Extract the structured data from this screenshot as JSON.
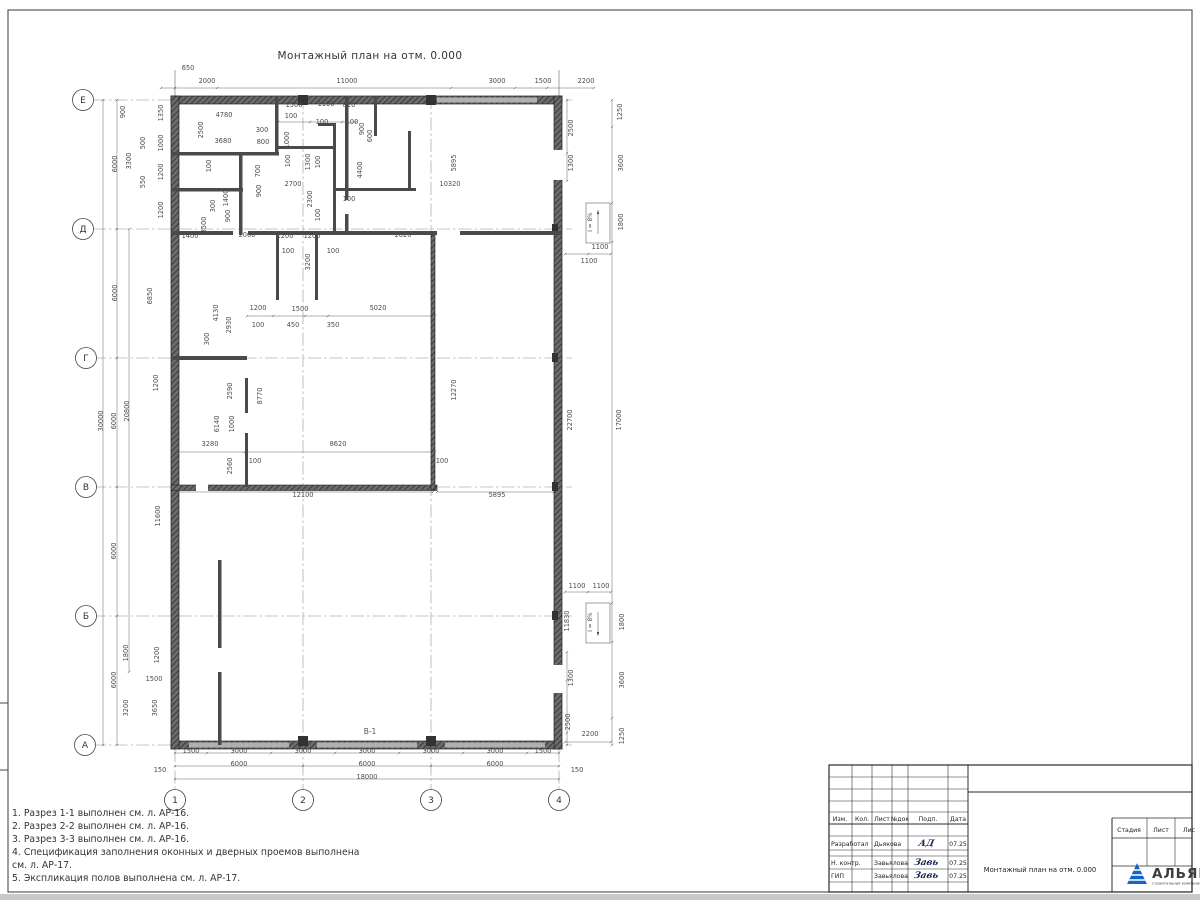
{
  "sheet": {
    "drawing_title": "Монтажный план на отм. 0.000",
    "window_mark": "В-1",
    "ramp_label": "i = 8%"
  },
  "axes": {
    "rows": [
      {
        "label": "Е",
        "x": 83,
        "y": 100
      },
      {
        "label": "Д",
        "x": 83,
        "y": 229
      },
      {
        "label": "Г",
        "x": 86,
        "y": 358
      },
      {
        "label": "В",
        "x": 86,
        "y": 487
      },
      {
        "label": "Б",
        "x": 86,
        "y": 616
      },
      {
        "label": "А",
        "x": 85,
        "y": 745
      }
    ],
    "cols": [
      {
        "label": "1",
        "x": 175,
        "y": 800
      },
      {
        "label": "2",
        "x": 303,
        "y": 800
      },
      {
        "label": "3",
        "x": 431,
        "y": 800
      },
      {
        "label": "4",
        "x": 559,
        "y": 800
      }
    ]
  },
  "dimensions": [
    {
      "x": 188,
      "y": 70,
      "t": "650"
    },
    {
      "x": 207,
      "y": 83,
      "t": "2000"
    },
    {
      "x": 347,
      "y": 83,
      "t": "11000"
    },
    {
      "x": 497,
      "y": 83,
      "t": "3000"
    },
    {
      "x": 543,
      "y": 83,
      "t": "1500"
    },
    {
      "x": 586,
      "y": 83,
      "t": "2200"
    },
    {
      "x": 294,
      "y": 107,
      "t": "1500"
    },
    {
      "x": 326,
      "y": 106,
      "t": "1100"
    },
    {
      "x": 349,
      "y": 107,
      "t": "820"
    },
    {
      "x": 291,
      "y": 118,
      "t": "100"
    },
    {
      "x": 322,
      "y": 124,
      "t": "100"
    },
    {
      "x": 352,
      "y": 124,
      "t": "100"
    },
    {
      "x": 364,
      "y": 129,
      "t": "900",
      "r": 1
    },
    {
      "x": 372,
      "y": 136,
      "t": "600",
      "r": 1
    },
    {
      "x": 117,
      "y": 164,
      "t": "6000",
      "r": 1
    },
    {
      "x": 117,
      "y": 293,
      "t": "6000",
      "r": 1
    },
    {
      "x": 116,
      "y": 421,
      "t": "6000",
      "r": 1
    },
    {
      "x": 116,
      "y": 551,
      "t": "6000",
      "r": 1
    },
    {
      "x": 116,
      "y": 680,
      "t": "6000",
      "r": 1
    },
    {
      "x": 103,
      "y": 421,
      "t": "30000",
      "r": 1
    },
    {
      "x": 129,
      "y": 411,
      "t": "20800",
      "r": 1
    },
    {
      "x": 160,
      "y": 516,
      "t": "11600",
      "r": 1
    },
    {
      "x": 152,
      "y": 296,
      "t": "6850",
      "r": 1
    },
    {
      "x": 125,
      "y": 112,
      "t": "900",
      "r": 1
    },
    {
      "x": 131,
      "y": 161,
      "t": "3300",
      "r": 1
    },
    {
      "x": 145,
      "y": 143,
      "t": "500",
      "r": 1
    },
    {
      "x": 145,
      "y": 182,
      "t": "550",
      "r": 1
    },
    {
      "x": 163,
      "y": 113,
      "t": "1350",
      "r": 1
    },
    {
      "x": 163,
      "y": 143,
      "t": "1000",
      "r": 1
    },
    {
      "x": 163,
      "y": 172,
      "t": "1200",
      "r": 1
    },
    {
      "x": 163,
      "y": 210,
      "t": "1200",
      "r": 1
    },
    {
      "x": 158,
      "y": 383,
      "t": "1200",
      "r": 1
    },
    {
      "x": 128,
      "y": 653,
      "t": "1800",
      "r": 1
    },
    {
      "x": 159,
      "y": 655,
      "t": "1200",
      "r": 1
    },
    {
      "x": 128,
      "y": 708,
      "t": "3200",
      "r": 1
    },
    {
      "x": 157,
      "y": 708,
      "t": "3650",
      "r": 1
    },
    {
      "x": 154,
      "y": 681,
      "t": "1500"
    },
    {
      "x": 191,
      "y": 753,
      "t": "1500"
    },
    {
      "x": 239,
      "y": 753,
      "t": "3000"
    },
    {
      "x": 303,
      "y": 753,
      "t": "3000"
    },
    {
      "x": 367,
      "y": 753,
      "t": "3000"
    },
    {
      "x": 431,
      "y": 753,
      "t": "3000"
    },
    {
      "x": 495,
      "y": 753,
      "t": "3000"
    },
    {
      "x": 543,
      "y": 753,
      "t": "1500"
    },
    {
      "x": 239,
      "y": 766,
      "t": "6000"
    },
    {
      "x": 367,
      "y": 766,
      "t": "6000"
    },
    {
      "x": 495,
      "y": 766,
      "t": "6000"
    },
    {
      "x": 367,
      "y": 779,
      "t": "18000"
    },
    {
      "x": 160,
      "y": 772,
      "t": "150"
    },
    {
      "x": 577,
      "y": 772,
      "t": "150"
    },
    {
      "x": 573,
      "y": 128,
      "t": "2500",
      "r": 1
    },
    {
      "x": 573,
      "y": 163,
      "t": "1300",
      "r": 1
    },
    {
      "x": 622,
      "y": 112,
      "t": "1250",
      "r": 1
    },
    {
      "x": 623,
      "y": 163,
      "t": "3600",
      "r": 1
    },
    {
      "x": 623,
      "y": 222,
      "t": "1800",
      "r": 1
    },
    {
      "x": 600,
      "y": 249,
      "t": "1100"
    },
    {
      "x": 589,
      "y": 263,
      "t": "1100"
    },
    {
      "x": 577,
      "y": 588,
      "t": "1100"
    },
    {
      "x": 601,
      "y": 588,
      "t": "1100"
    },
    {
      "x": 624,
      "y": 622,
      "t": "1800",
      "r": 1
    },
    {
      "x": 624,
      "y": 680,
      "t": "3600",
      "r": 1
    },
    {
      "x": 624,
      "y": 736,
      "t": "1250",
      "r": 1
    },
    {
      "x": 590,
      "y": 736,
      "t": "2200"
    },
    {
      "x": 573,
      "y": 678,
      "t": "1300",
      "r": 1
    },
    {
      "x": 570,
      "y": 722,
      "t": "2500",
      "r": 1
    },
    {
      "x": 572,
      "y": 420,
      "t": "22700",
      "r": 1
    },
    {
      "x": 621,
      "y": 420,
      "t": "17000",
      "r": 1
    },
    {
      "x": 569,
      "y": 621,
      "t": "11830",
      "r": 1
    },
    {
      "x": 456,
      "y": 390,
      "t": "12270",
      "r": 1
    },
    {
      "x": 224,
      "y": 117,
      "t": "4780"
    },
    {
      "x": 203,
      "y": 130,
      "t": "2500",
      "r": 1
    },
    {
      "x": 223,
      "y": 143,
      "t": "3680"
    },
    {
      "x": 262,
      "y": 132,
      "t": "300"
    },
    {
      "x": 263,
      "y": 144,
      "t": "800"
    },
    {
      "x": 289,
      "y": 140,
      "t": "1000",
      "r": 1
    },
    {
      "x": 310,
      "y": 162,
      "t": "1300",
      "r": 1
    },
    {
      "x": 290,
      "y": 161,
      "t": "100",
      "r": 1
    },
    {
      "x": 320,
      "y": 162,
      "t": "100",
      "r": 1
    },
    {
      "x": 260,
      "y": 171,
      "t": "700",
      "r": 1
    },
    {
      "x": 261,
      "y": 191,
      "t": "900",
      "r": 1
    },
    {
      "x": 293,
      "y": 186,
      "t": "2700"
    },
    {
      "x": 312,
      "y": 199,
      "t": "2300",
      "r": 1
    },
    {
      "x": 349,
      "y": 201,
      "t": "100"
    },
    {
      "x": 320,
      "y": 215,
      "t": "100",
      "r": 1
    },
    {
      "x": 362,
      "y": 170,
      "t": "4400",
      "r": 1
    },
    {
      "x": 211,
      "y": 166,
      "t": "100",
      "r": 1
    },
    {
      "x": 228,
      "y": 198,
      "t": "1400",
      "r": 1
    },
    {
      "x": 215,
      "y": 206,
      "t": "300",
      "r": 1
    },
    {
      "x": 230,
      "y": 216,
      "t": "900",
      "r": 1
    },
    {
      "x": 206,
      "y": 225,
      "t": "3500",
      "r": 1
    },
    {
      "x": 190,
      "y": 238,
      "t": "1400"
    },
    {
      "x": 247,
      "y": 237,
      "t": "2000"
    },
    {
      "x": 285,
      "y": 238,
      "t": "1200"
    },
    {
      "x": 312,
      "y": 238,
      "t": "1200"
    },
    {
      "x": 403,
      "y": 237,
      "t": "2620"
    },
    {
      "x": 288,
      "y": 253,
      "t": "100"
    },
    {
      "x": 333,
      "y": 253,
      "t": "100"
    },
    {
      "x": 310,
      "y": 262,
      "t": "3200",
      "r": 1
    },
    {
      "x": 258,
      "y": 310,
      "t": "1200"
    },
    {
      "x": 300,
      "y": 311,
      "t": "1500"
    },
    {
      "x": 378,
      "y": 310,
      "t": "5020"
    },
    {
      "x": 293,
      "y": 327,
      "t": "450"
    },
    {
      "x": 333,
      "y": 327,
      "t": "350"
    },
    {
      "x": 258,
      "y": 327,
      "t": "100"
    },
    {
      "x": 218,
      "y": 313,
      "t": "4130",
      "r": 1
    },
    {
      "x": 231,
      "y": 325,
      "t": "2930",
      "r": 1
    },
    {
      "x": 209,
      "y": 339,
      "t": "300",
      "r": 1
    },
    {
      "x": 232,
      "y": 391,
      "t": "2590",
      "r": 1
    },
    {
      "x": 262,
      "y": 396,
      "t": "8770",
      "r": 1
    },
    {
      "x": 219,
      "y": 424,
      "t": "6140",
      "r": 1
    },
    {
      "x": 234,
      "y": 424,
      "t": "1000",
      "r": 1
    },
    {
      "x": 210,
      "y": 446,
      "t": "3280"
    },
    {
      "x": 338,
      "y": 446,
      "t": "8620"
    },
    {
      "x": 232,
      "y": 466,
      "t": "2560",
      "r": 1
    },
    {
      "x": 255,
      "y": 463,
      "t": "100"
    },
    {
      "x": 442,
      "y": 463,
      "t": "100"
    },
    {
      "x": 303,
      "y": 497,
      "t": "12100"
    },
    {
      "x": 497,
      "y": 497,
      "t": "5895"
    },
    {
      "x": 456,
      "y": 163,
      "t": "5895",
      "r": 1
    },
    {
      "x": 450,
      "y": 186,
      "t": "10320"
    }
  ],
  "notes": [
    "1. Разрез 1-1 выполнен см. л. АР-16.",
    "2. Разрез 2-2 выполнен см. л. АР-16.",
    "3. Разрез 3-3 выполнен см. л. АР-16.",
    "4. Спецификация заполнения оконных и дверных проемов выполнена",
    "см. л. АР-17.",
    "5. Экспликация полов выполнена см. л. АР-17."
  ],
  "titleblock": {
    "columns": [
      "Изм.",
      "Кол.",
      "Лист",
      "№док",
      "Подп.",
      "Дата"
    ],
    "rows": [
      {
        "role": "Разработал",
        "name": "Дьякова",
        "sig": "АД",
        "date": "07.25"
      },
      {
        "role": "Н. контр.",
        "name": "Завьялова",
        "sig": "Завь",
        "date": "07.25"
      },
      {
        "role": "ГИП",
        "name": "Завьялова",
        "sig": "Завь",
        "date": "07.25"
      }
    ],
    "stage_headers": [
      "Стадия",
      "Лист",
      "Лис"
    ],
    "doc_title": "Монтажный план на отм. 0.000",
    "logo_text": "АЛЬЯНС",
    "logo_tagline": "строительная компания",
    "logo_color": "#1464c8",
    "logo_tag_color": "#3c85d8"
  }
}
